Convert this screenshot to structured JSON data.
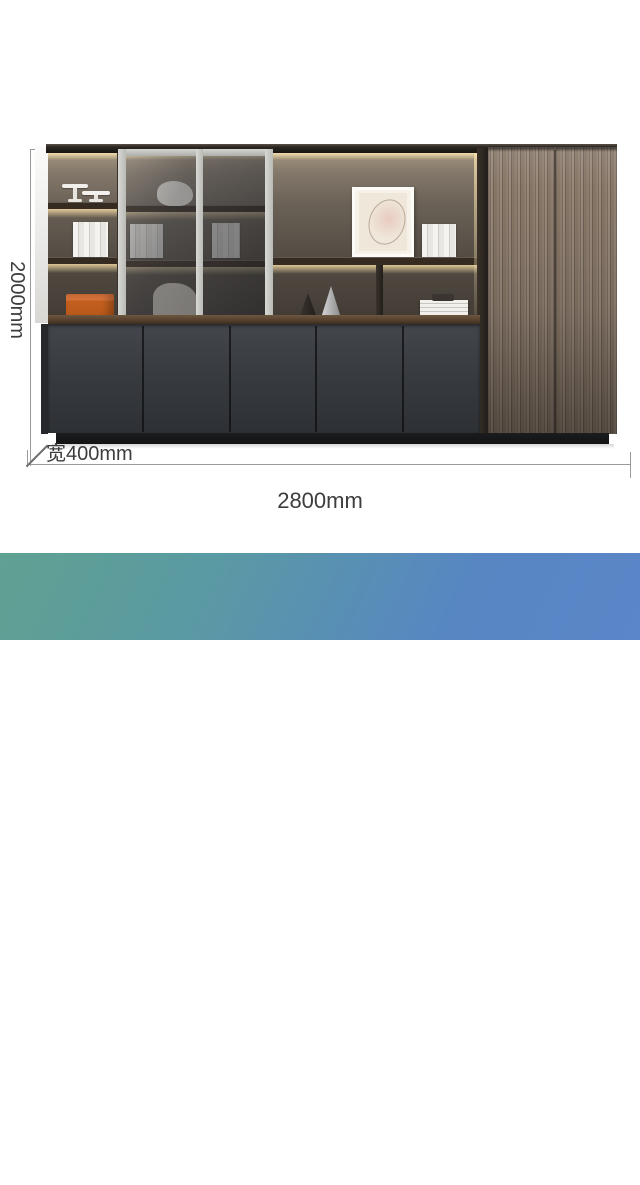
{
  "banner": {
    "title": "七门文件柜",
    "subtitle": "尺寸：长2800宽400*高2000(mm)",
    "gradient_start": "#5fa191",
    "gradient_end": "#5b86c8",
    "text_color": "#ffffff"
  },
  "dimensions": {
    "height_label": "2000mm",
    "depth_label": "宽400mm",
    "length_label": "2800mm",
    "line_color": "#9a9a9a",
    "text_color": "#3d3d3d"
  },
  "colors": {
    "wood_grain": "#8a7a6c",
    "lower_doors_charcoal": "#383b3e",
    "interior_back": "#6a6156",
    "led_glow": "#ffe9b4",
    "storage_box_orange": "#c4601f",
    "glass_frame": "#c6c6c2",
    "plinth_black": "#17181a"
  }
}
